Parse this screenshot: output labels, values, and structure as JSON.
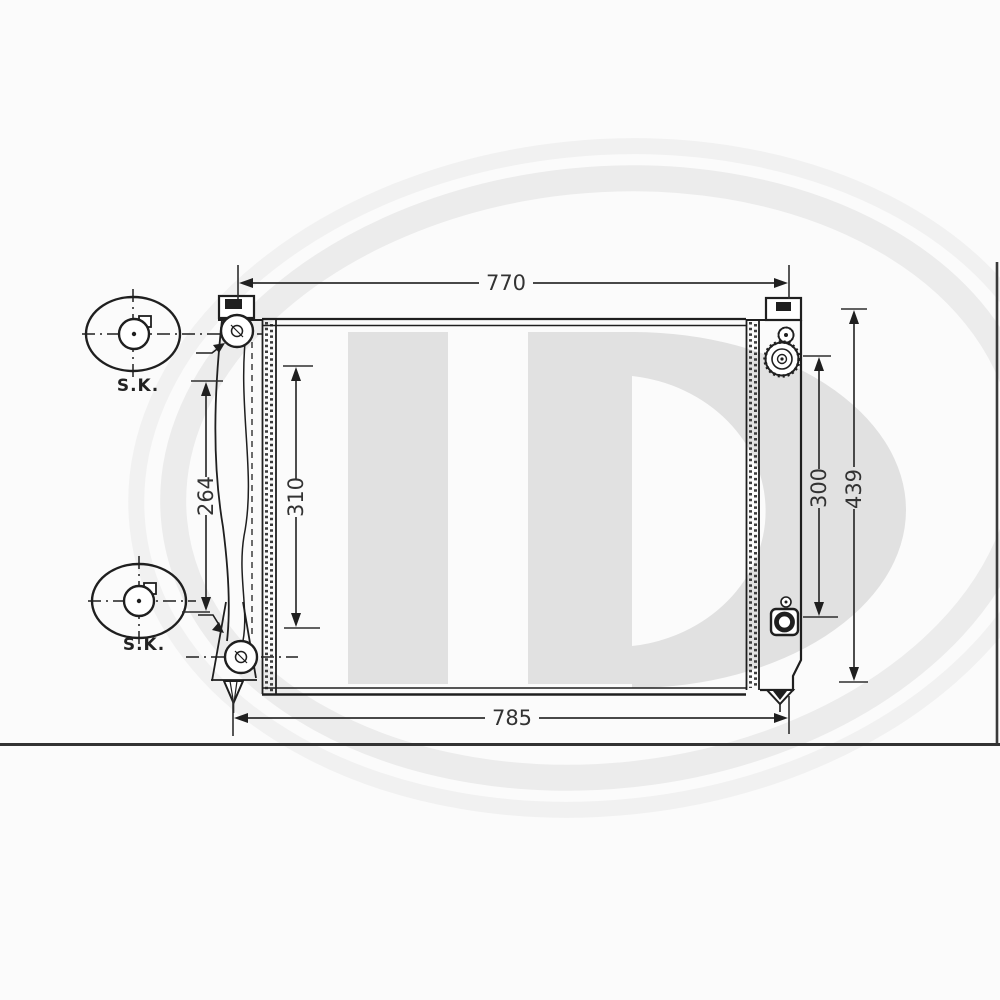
{
  "page": {
    "background": "#fbfbfb",
    "frame_line_color": "#333333"
  },
  "watermark": {
    "letters": "HD",
    "letter_color": "#e1e1e1",
    "swoosh_color": "#ececec"
  },
  "diagram": {
    "subject": "radiator front view technical drawing",
    "line_color": "#1f1f1f",
    "dim_color": "#2e2e2e",
    "dimensions": {
      "top_width": {
        "value": "770",
        "orientation": "horizontal",
        "position": "top"
      },
      "bottom_width": {
        "value": "785",
        "orientation": "horizontal",
        "position": "bottom"
      },
      "left_mount": {
        "value": "264",
        "orientation": "vertical",
        "position": "left-outer"
      },
      "left_core": {
        "value": "310",
        "orientation": "vertical",
        "position": "left-inner"
      },
      "right_core": {
        "value": "300",
        "orientation": "vertical",
        "position": "right-inner"
      },
      "right_overall": {
        "value": "439",
        "orientation": "vertical",
        "position": "right-outer"
      }
    },
    "callouts": {
      "top_label": "S.K.",
      "bottom_label": "S.K."
    }
  }
}
